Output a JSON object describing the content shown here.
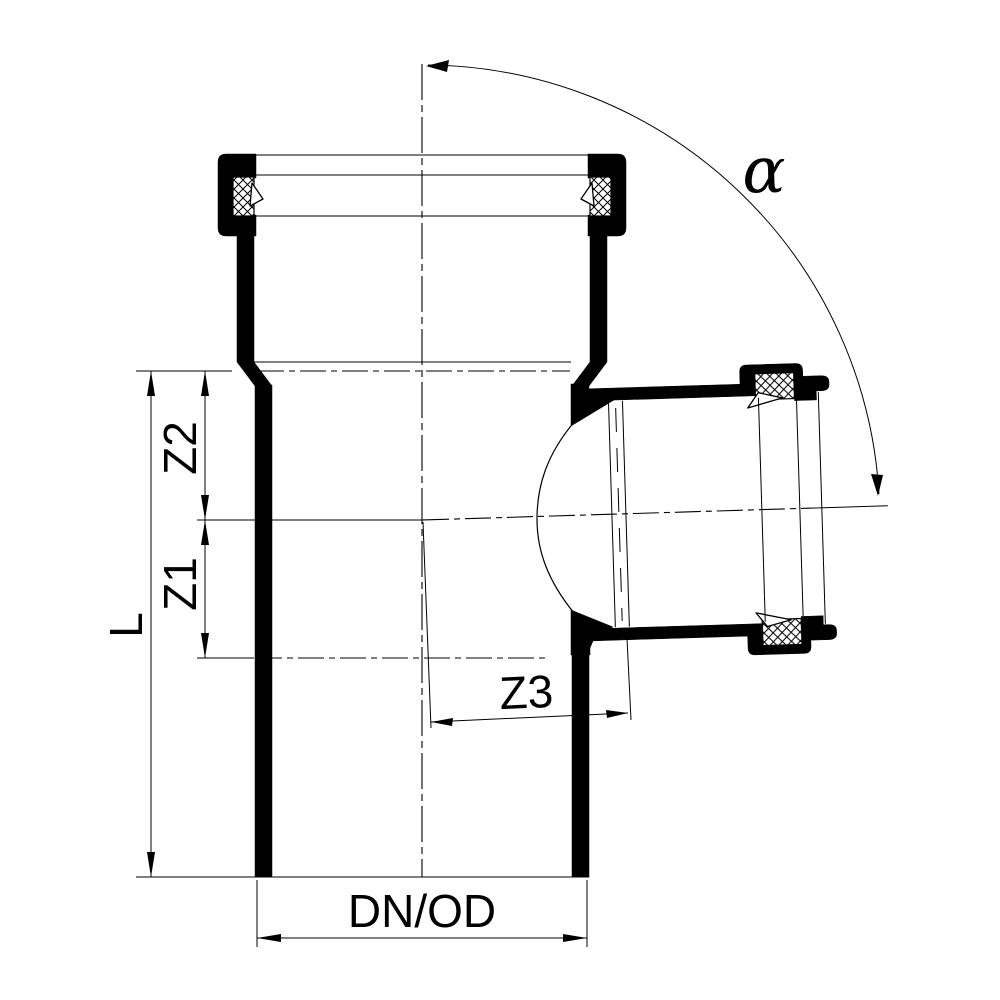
{
  "drawing": {
    "labels": {
      "length": "L",
      "z1": "Z1",
      "z2": "Z2",
      "z3": "Z3",
      "diameter": "DN/OD",
      "angle": "α"
    },
    "colors": {
      "line": "#000000",
      "background": "#ffffff"
    }
  }
}
